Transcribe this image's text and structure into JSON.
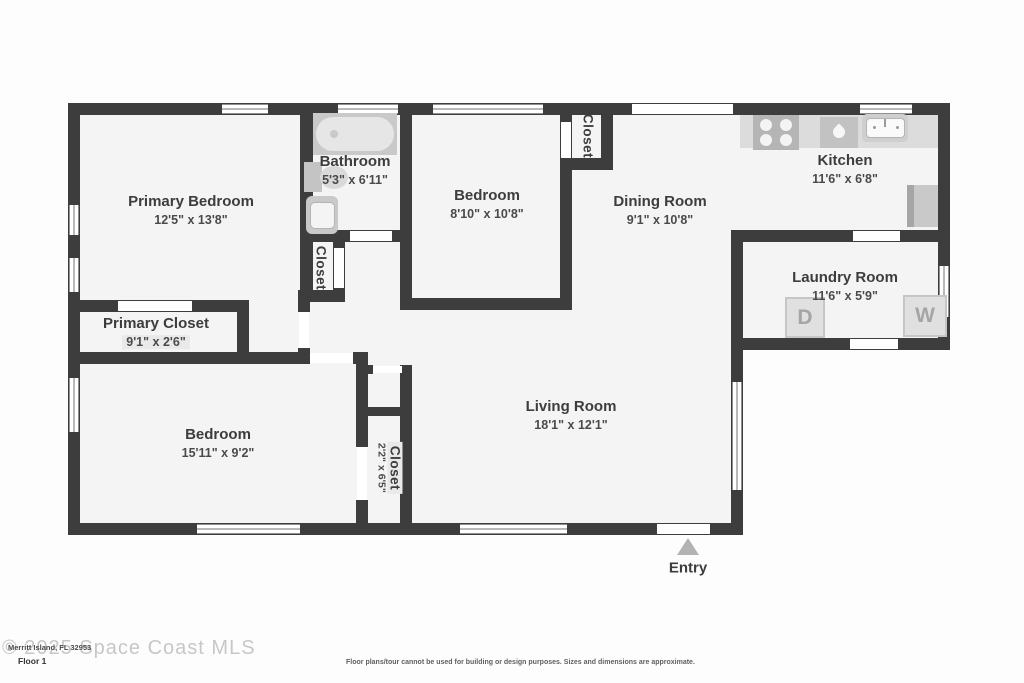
{
  "floorplan": {
    "rooms": {
      "primary_bedroom": {
        "name": "Primary Bedroom",
        "dims": "12'5\" x 13'8\""
      },
      "bathroom": {
        "name": "Bathroom",
        "dims": "5'3\" x 6'11\""
      },
      "hall_closet": {
        "name": "Closet"
      },
      "bedroom_2": {
        "name": "Bedroom",
        "dims": "8'10\" x 10'8\""
      },
      "bedroom_2_closet": {
        "name": "Closet"
      },
      "dining_room": {
        "name": "Dining Room",
        "dims": "9'1\" x 10'8\""
      },
      "kitchen": {
        "name": "Kitchen",
        "dims": "11'6\" x 6'8\""
      },
      "laundry_room": {
        "name": "Laundry Room",
        "dims": "11'6\" x 5'9\""
      },
      "primary_closet": {
        "name": "Primary Closet",
        "dims": "9'1\" x 2'6\""
      },
      "bedroom_3": {
        "name": "Bedroom",
        "dims": "15'11\" x 9'2\""
      },
      "bedroom_3_closet": {
        "name": "Closet",
        "dims": "2'2\" x 6'5\""
      },
      "living_room": {
        "name": "Living Room",
        "dims": "18'1\" x 12'1\""
      }
    },
    "entry_label": "Entry",
    "appliances": {
      "dryer_label": "D",
      "washer_label": "W"
    }
  },
  "footer": {
    "floor_label": "Floor 1",
    "address": "Merritt Island, FL 32953",
    "watermark": "© 2025 Space Coast MLS",
    "disclaimer": "Floor plans/tour cannot be used for building or design purposes. Sizes and dimensions are approximate."
  },
  "colors": {
    "wall": "#3d3d3d",
    "floor": "#f4f4f4",
    "fixture": "#c9c9c9",
    "label_text": "#3d3d3d"
  }
}
